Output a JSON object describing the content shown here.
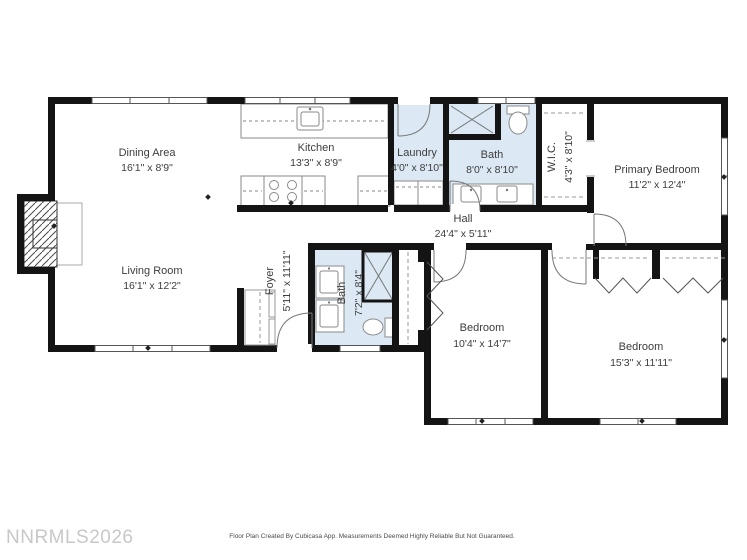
{
  "watermark": "NNRMLS2026",
  "footer": "Floor Plan Created By Cubicasa App. Measurements Deemed Highly Reliable But Not Guaranteed.",
  "colors": {
    "wall": "#141414",
    "wet_room_fill": "#dce9f5",
    "label_text": "#3d3d3d",
    "watermark_text": "#c8c8c8",
    "fixture_line": "#8a8a8a"
  },
  "rooms": {
    "dining": {
      "name": "Dining Area",
      "dims": "16'1\" x 8'9\""
    },
    "kitchen": {
      "name": "Kitchen",
      "dims": "13'3\" x 8'9\""
    },
    "laundry": {
      "name": "Laundry",
      "dims": "4'0\" x 8'10\""
    },
    "bath_top": {
      "name": "Bath",
      "dims": "8'0\" x 8'10\""
    },
    "wic": {
      "name": "W.I.C.",
      "dims": "4'3\" x 8'10\""
    },
    "primary_bedroom": {
      "name": "Primary Bedroom",
      "dims": "11'2\" x 12'4\""
    },
    "hall": {
      "name": "Hall",
      "dims": "24'4\" x 5'11\""
    },
    "living": {
      "name": "Living Room",
      "dims": "16'1\" x 12'2\""
    },
    "foyer": {
      "name": "Foyer",
      "dims": "5'11\" x 11'11\""
    },
    "bath_bottom": {
      "name": "Bath",
      "dims": "7'2\" x 8'4\""
    },
    "bedroom_mid": {
      "name": "Bedroom",
      "dims": "10'4\" x 14'7\""
    },
    "bedroom_right": {
      "name": "Bedroom",
      "dims": "15'3\" x 11'11\""
    }
  }
}
